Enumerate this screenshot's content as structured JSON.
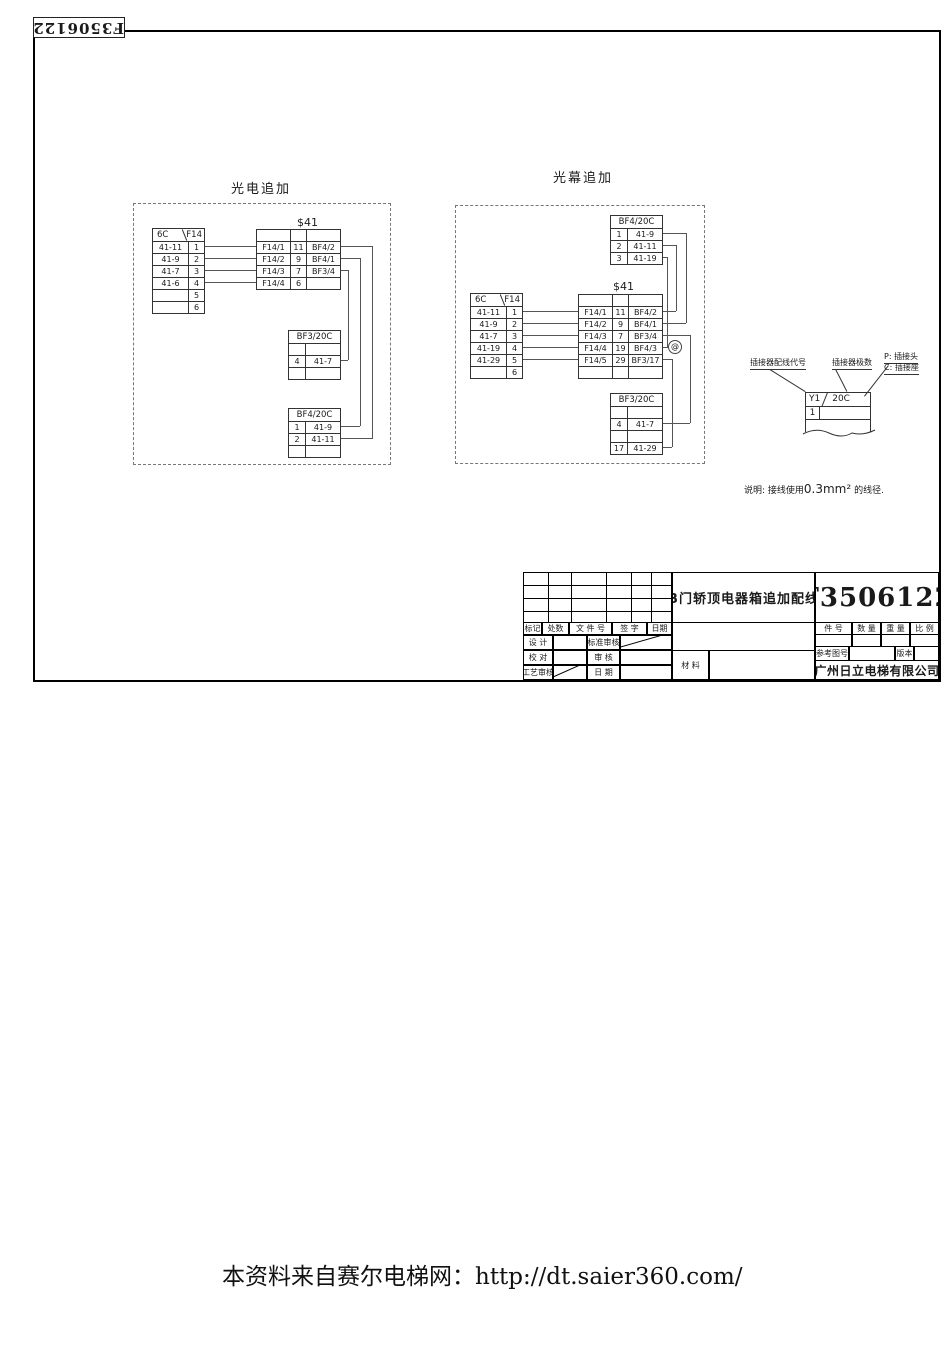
{
  "page": {
    "corner_number": "F3506122",
    "watermark": "本资料来自赛尔电梯网：http://dt.saier360.com/",
    "colors": {
      "ink": "#1a1a1a",
      "wire": "#555555"
    }
  },
  "photoelectric": {
    "title": "光电追加",
    "source_table": {
      "header_left": "6C",
      "header_right": "F14",
      "rows": [
        [
          "41-11",
          "1"
        ],
        [
          "41-9",
          "2"
        ],
        [
          "41-7",
          "3"
        ],
        [
          "41-6",
          "4"
        ],
        [
          "",
          "5"
        ],
        [
          "",
          "6"
        ]
      ]
    },
    "s41": {
      "title": "$41",
      "rows": [
        [
          "",
          "",
          ""
        ],
        [
          "F14/1",
          "11",
          "BF4/2"
        ],
        [
          "F14/2",
          "9",
          "BF4/1"
        ],
        [
          "F14/3",
          "7",
          "BF3/4"
        ],
        [
          "F14/4",
          "6",
          ""
        ]
      ]
    },
    "bf3": {
      "title": "BF3/20C",
      "rows": [
        [
          "",
          ""
        ],
        [
          "4",
          "41-7"
        ],
        [
          "",
          ""
        ]
      ]
    },
    "bf4": {
      "title": "BF4/20C",
      "rows": [
        [
          "1",
          "41-9"
        ],
        [
          "2",
          "41-11"
        ],
        [
          "",
          ""
        ]
      ]
    }
  },
  "light_curtain": {
    "title": "光幕追加",
    "bf4": {
      "title": "BF4/20C",
      "rows": [
        [
          "1",
          "41-9"
        ],
        [
          "2",
          "41-11"
        ],
        [
          "3",
          "41-19"
        ]
      ]
    },
    "source_table": {
      "header_left": "6C",
      "header_right": "F14",
      "rows": [
        [
          "41-11",
          "1"
        ],
        [
          "41-9",
          "2"
        ],
        [
          "41-7",
          "3"
        ],
        [
          "41-19",
          "4"
        ],
        [
          "41-29",
          "5"
        ],
        [
          "",
          "6"
        ]
      ]
    },
    "s41": {
      "title": "$41",
      "rows": [
        [
          "",
          "",
          ""
        ],
        [
          "F14/1",
          "11",
          "BF4/2"
        ],
        [
          "F14/2",
          "9",
          "BF4/1"
        ],
        [
          "F14/3",
          "7",
          "BF3/4"
        ],
        [
          "F14/4",
          "19",
          "BF4/3"
        ],
        [
          "F14/5",
          "29",
          "BF3/17"
        ],
        [
          "",
          "",
          ""
        ]
      ]
    },
    "bf3": {
      "title": "BF3/20C",
      "rows": [
        [
          "",
          ""
        ],
        [
          "4",
          "41-7"
        ],
        [
          "",
          ""
        ],
        [
          "17",
          "41-29"
        ]
      ]
    },
    "junction": "@"
  },
  "legend": {
    "label_wiring_code": "插接器配线代号",
    "label_pole_count": "插接器极数",
    "label_plug": "P: 插接头",
    "label_socket": "C: 插接座",
    "sample": {
      "code": "Y1",
      "poles": "20C",
      "pin": "1"
    }
  },
  "note": {
    "prefix": "说明: 接线使用",
    "wire_size": "0.3mm²",
    "suffix": "的线径."
  },
  "title_block": {
    "drawing_title": "B门轿顶电器箱追加配线",
    "drawing_number": "F3506122",
    "company": "广州日立电梯有限公司",
    "labels": {
      "mark": "标记",
      "count": "处数",
      "file_no": "文 件 号",
      "signature": "签  字",
      "date": "日期",
      "design": "设 计",
      "standard_check": "标准审核",
      "proofread": "校 对",
      "check": "审 核",
      "process_check": "工艺审核",
      "date2": "日 期",
      "material": "材 料",
      "part_no": "件  号",
      "quantity": "数 量",
      "weight": "重 量",
      "scale": "比 例",
      "ref_drawing_no": "参考图号",
      "version": "版本"
    }
  }
}
